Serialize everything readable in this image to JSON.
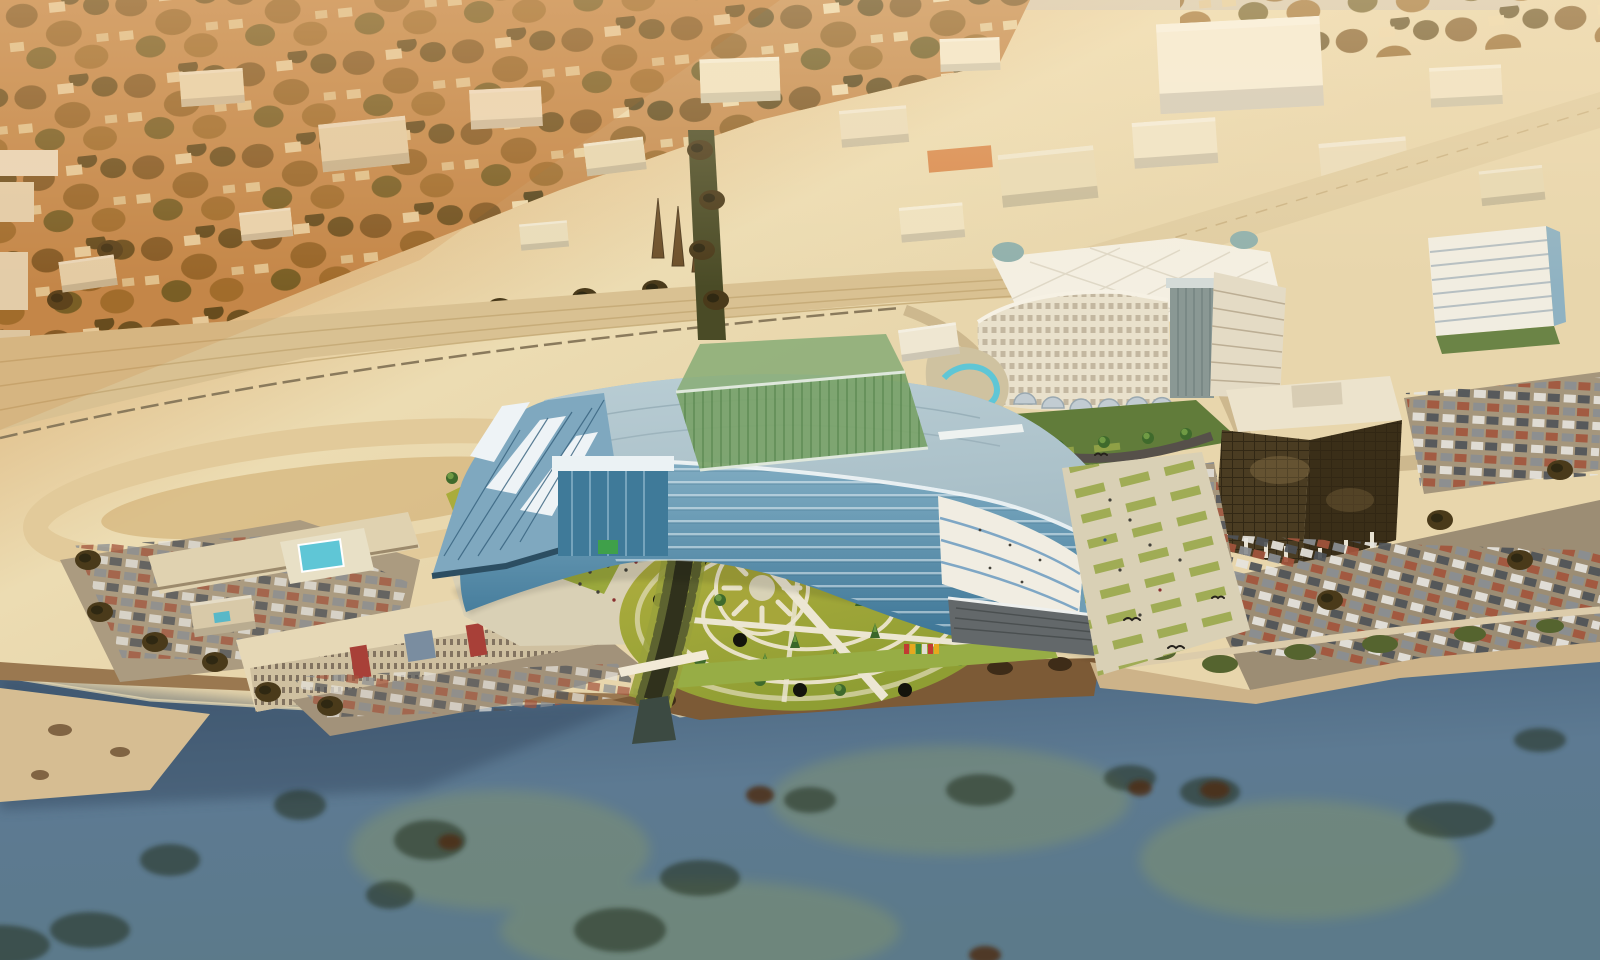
{
  "meta": {
    "type": "aerial-architectural-rendering",
    "description": "Oblique aerial photograph of a coastal city in warm sepia tones with a proposed crescent-shaped glass building rendered onto the waterfront site. A green glass bridge wing crosses a creek that flows to the sea; a circular ornamental garden sits in front. Existing motel, large white hotel, dark glass office tower and car-filled parking lots surround the site; kelp-dotted ocean fills the foreground."
  },
  "scene": {
    "regions": [
      {
        "name": "residential-neighborhood",
        "desc": "dense sepia-toned houses and trees, upper left"
      },
      {
        "name": "industrial-district",
        "desc": "cream flat-roof warehouses across the top"
      },
      {
        "name": "highway-corridor",
        "desc": "wide tan multi-lane highway crossing mid-frame with loop ramp"
      },
      {
        "name": "creek-corridor",
        "desc": "tree-lined creek running under the building to the shore"
      },
      {
        "name": "proposed-crescent-building",
        "desc": "curved blue glass building with large gray roof"
      },
      {
        "name": "green-glass-bridge",
        "desc": "translucent green planted glass bar crossing the roof"
      },
      {
        "name": "circular-garden-plaza",
        "desc": "yellow-green garden with sun motif and concentric paths"
      },
      {
        "name": "motel-complex",
        "desc": "beige three-story motel with red stair towers and turquoise pool"
      },
      {
        "name": "hotel",
        "desc": "large white hotel with quilted ballroom roof and arched canopies"
      },
      {
        "name": "office-tower",
        "desc": "dark bronze glass cube tower with white roof"
      },
      {
        "name": "parking-lots",
        "desc": "lots full of parked cars east and south"
      },
      {
        "name": "ocean",
        "desc": "blue-green water with dark kelp beds along rocky shoreline"
      }
    ],
    "counts": {
      "skylight-strips": 3,
      "garden-arc-paths": 4,
      "hotel-arch-canopies": 6
    }
  },
  "palette": {
    "land_orange": "#c08248",
    "land_cream": "#ecdcb2",
    "road": "#d9c192",
    "water_deep": "#46617c",
    "water_mid": "#5d7a92",
    "kelp_dark": "#232e1d",
    "sand": "#d6bd92",
    "creek": "#30311c",
    "glass_dark": "#3a7394",
    "glass_mid": "#6f9fb8",
    "glass_light": "#9fc2d2",
    "roof_gray": "#a3bac3",
    "green_bridge": "#7aa369",
    "garden_yellow": "#b4b040",
    "garden_green": "#8f9e33",
    "plaza": "#d9d0b5",
    "motel": "#e6d8b6",
    "motel_red": "#a84038",
    "pool": "#5fc6d6",
    "hotel_white": "#f4efe2",
    "hotel_face": "#e9e1cc",
    "tower_dark": "#4a3c22",
    "parking": "#9c8d74",
    "midrise": "#f1ede1"
  }
}
